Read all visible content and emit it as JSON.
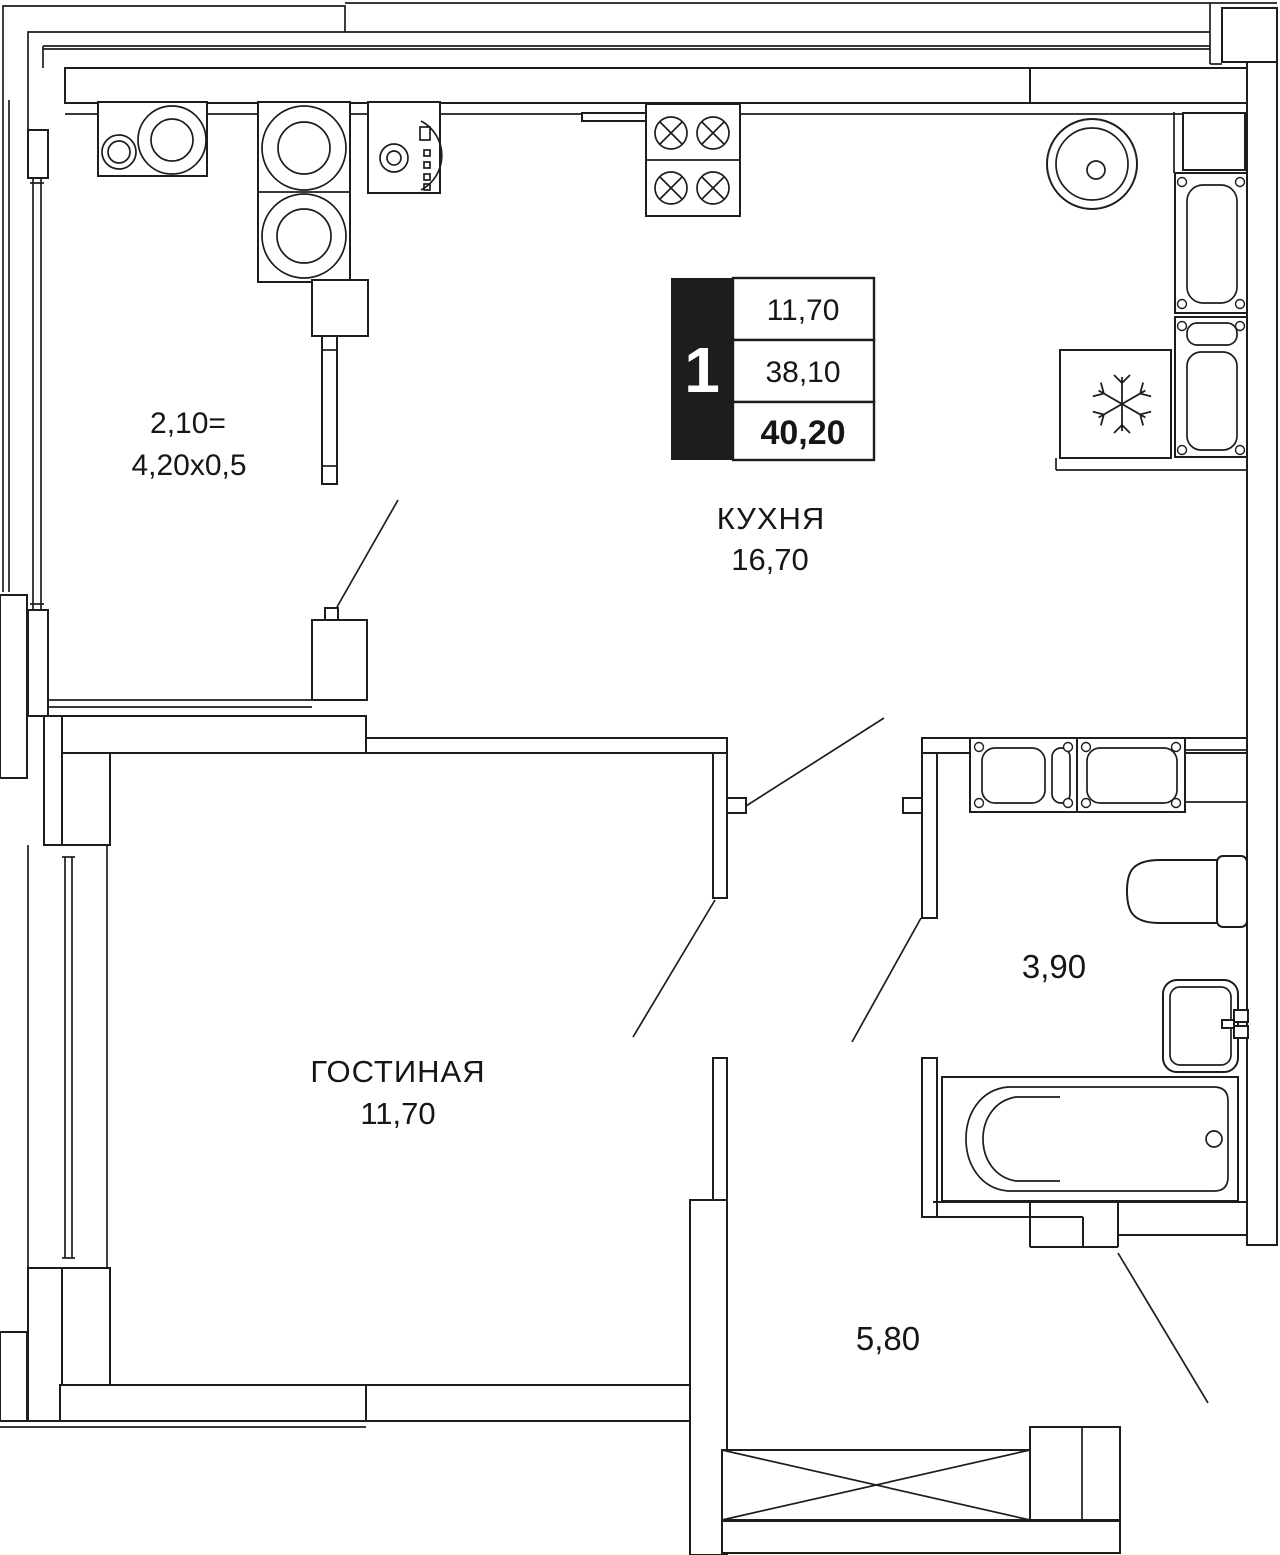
{
  "meta": {
    "kind": "apartment-floor-plan",
    "language": "ru",
    "colors": {
      "ink": "#1d1d1d",
      "background": "#ffffff"
    }
  },
  "legend": {
    "rooms_count": "1",
    "row1": "11,70",
    "row2": "38,10",
    "row3_total": "40,20"
  },
  "rooms": {
    "kitchen": {
      "name": "КУХНЯ",
      "area": "16,70"
    },
    "living": {
      "name": "ГОСТИНАЯ",
      "area": "11,70"
    },
    "bathroom": {
      "area": "3,90"
    },
    "hallway": {
      "area": "5,80"
    },
    "balcony": {
      "line1": "2,10=",
      "line2": "4,20x0,5"
    }
  },
  "fixtures": [
    "double-bowl-sink-symbol",
    "two-ring-cooktop-symbol",
    "washing-machine-symbol",
    "four-burner-stove-symbol",
    "round-sink-symbol",
    "tall-cabinet-symbol",
    "radiator-panel-symbol",
    "refrigerator-snowflake-symbol",
    "laundry-unit-symbol",
    "toilet-symbol",
    "washbasin-symbol",
    "bathtub-symbol",
    "crossed-wardrobe-symbol",
    "door-swing-symbol"
  ]
}
